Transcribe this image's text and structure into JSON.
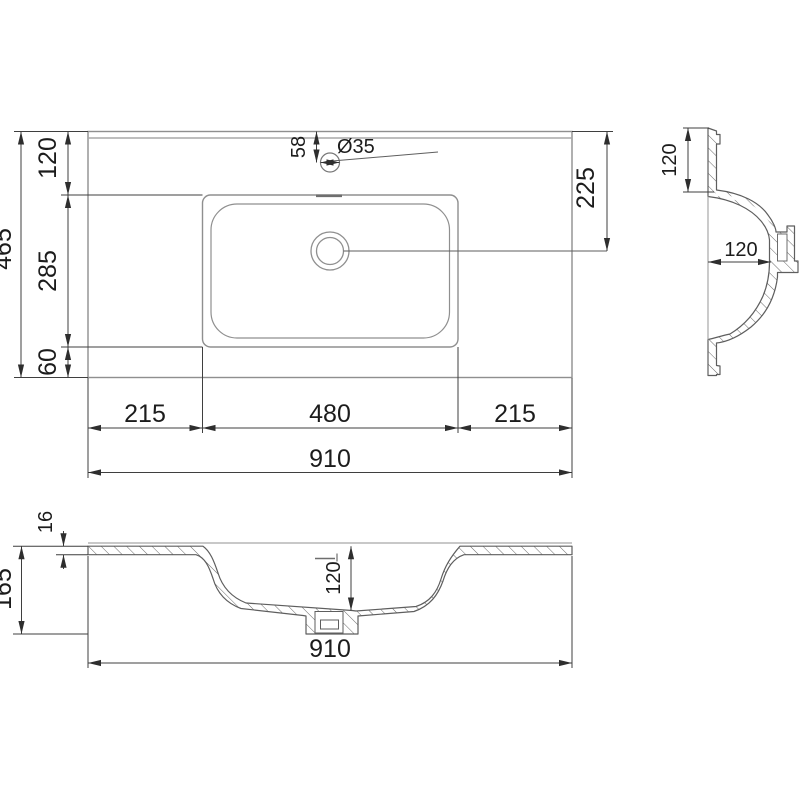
{
  "page": {
    "background": "#ffffff"
  },
  "colors": {
    "outline": "#8f8f8f",
    "outline_light": "#a8a8a8",
    "section": "#5e5e5e",
    "dimension": "#3f3f3f",
    "arrow": "#2e2e2e",
    "text": "#1c1c1c"
  },
  "plan_view": {
    "depth_total": "465",
    "depth_back": "120",
    "depth_basin": "285",
    "depth_front": "60",
    "faucet_offset": "58",
    "faucet_diameter": "Ø35",
    "drain_from_back": "225",
    "width_left": "215",
    "width_basin": "480",
    "width_right": "215",
    "width_total": "910"
  },
  "side_section": {
    "back_shelf_depth": "120",
    "bowl_depth": "120"
  },
  "front_section": {
    "top_thickness": "16",
    "height_total": "165",
    "bowl_depth": "120",
    "width_total": "910"
  }
}
